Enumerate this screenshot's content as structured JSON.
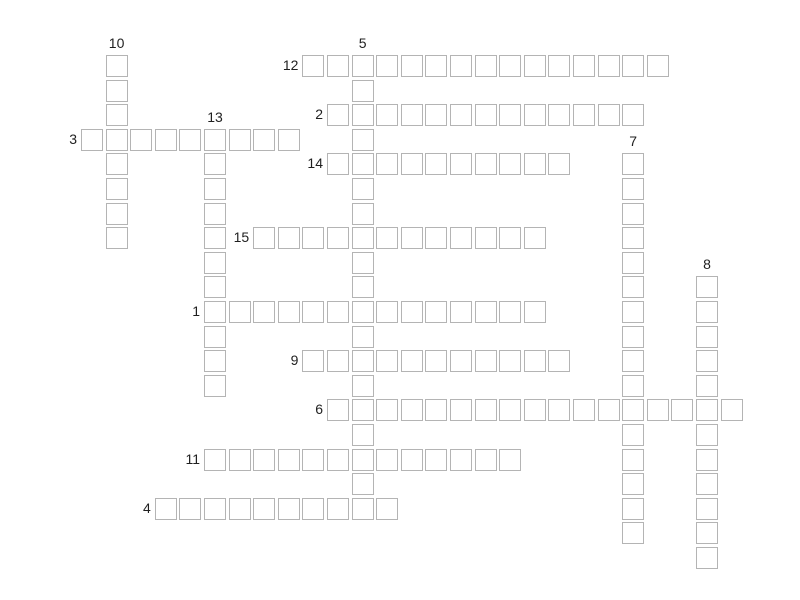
{
  "puzzle": {
    "type": "crossword",
    "background_color": "#ffffff",
    "cell_fill_color": "#ffffff",
    "cell_border_color": "#b4b4b4",
    "label_color": "#1f1f1f",
    "grid": {
      "origin_x": 81,
      "origin_y": 55,
      "pitch": 24.6,
      "cell_size": 22
    },
    "words": [
      {
        "num": "12",
        "dir": "across",
        "col": 9,
        "row": 0,
        "len": 15
      },
      {
        "num": "10",
        "dir": "down",
        "col": 1,
        "row": 0,
        "len": 8
      },
      {
        "num": "5",
        "dir": "down",
        "col": 11,
        "row": 0,
        "len": 19
      },
      {
        "num": "2",
        "dir": "across",
        "col": 10,
        "row": 2,
        "len": 13
      },
      {
        "num": "3",
        "dir": "across",
        "col": 0,
        "row": 3,
        "len": 9
      },
      {
        "num": "13",
        "dir": "down",
        "col": 5,
        "row": 3,
        "len": 11
      },
      {
        "num": "14",
        "dir": "across",
        "col": 10,
        "row": 4,
        "len": 10
      },
      {
        "num": "7",
        "dir": "down",
        "col": 22,
        "row": 4,
        "len": 16
      },
      {
        "num": "15",
        "dir": "across",
        "col": 7,
        "row": 7,
        "len": 12
      },
      {
        "num": "8",
        "dir": "down",
        "col": 25,
        "row": 9,
        "len": 12
      },
      {
        "num": "1",
        "dir": "across",
        "col": 5,
        "row": 10,
        "len": 14
      },
      {
        "num": "9",
        "dir": "across",
        "col": 9,
        "row": 12,
        "len": 11
      },
      {
        "num": "6",
        "dir": "across",
        "col": 10,
        "row": 14,
        "len": 17
      },
      {
        "num": "11",
        "dir": "across",
        "col": 5,
        "row": 16,
        "len": 13
      },
      {
        "num": "4",
        "dir": "across",
        "col": 3,
        "row": 18,
        "len": 10
      }
    ]
  }
}
